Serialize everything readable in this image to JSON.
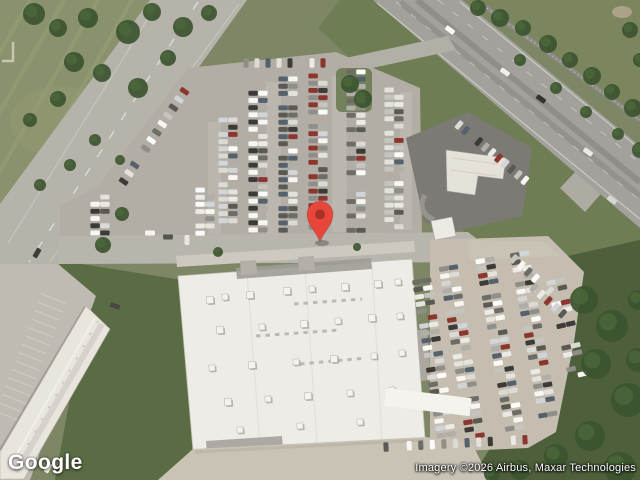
{
  "map": {
    "view": "satellite",
    "marker": {
      "name": "location-pin",
      "color": "#E8463B",
      "dot_color": "#9E2F24"
    }
  },
  "branding": {
    "logo_text": "Google"
  },
  "attribution": {
    "text": "Imagery ©2026 Airbus, Maxar Technologies"
  }
}
